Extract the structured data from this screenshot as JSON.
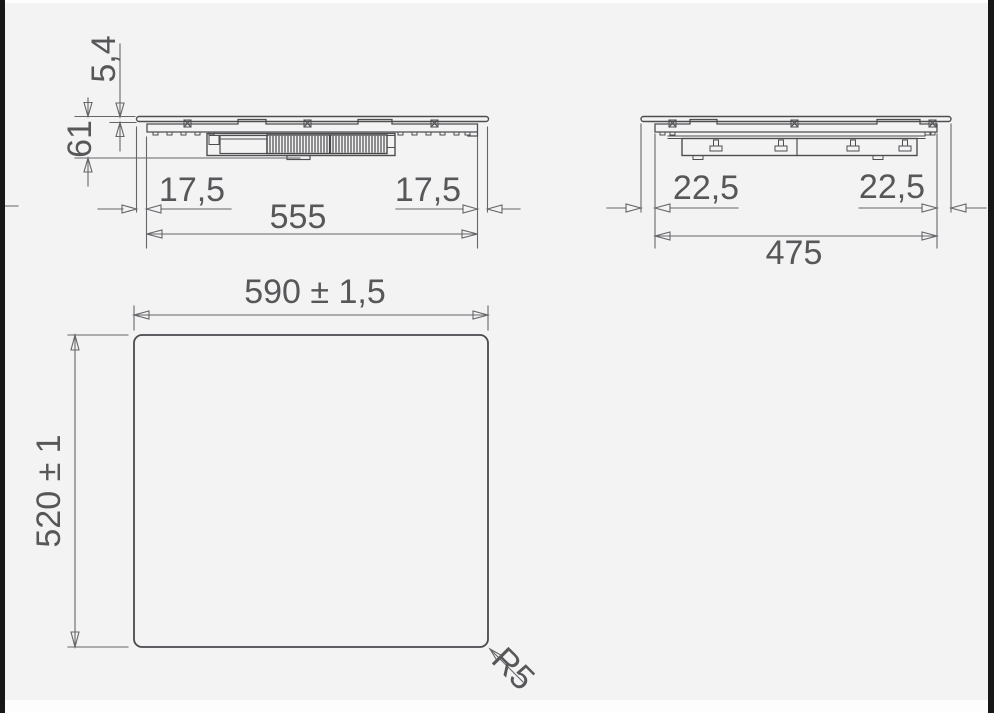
{
  "drawing": {
    "front_view": {
      "glass_thickness_mm": "5,4",
      "installed_height_mm": "61",
      "overhang_left_mm": "17,5",
      "overhang_right_mm": "17,5",
      "body_width_mm": "555"
    },
    "side_view": {
      "overhang_left_mm": "22,5",
      "overhang_right_mm": "22,5",
      "body_depth_mm": "475"
    },
    "top_view": {
      "cutout_width_mm": "590 ± 1,5",
      "cutout_depth_mm": "520 ± 1",
      "corner_radius": "R5"
    }
  }
}
